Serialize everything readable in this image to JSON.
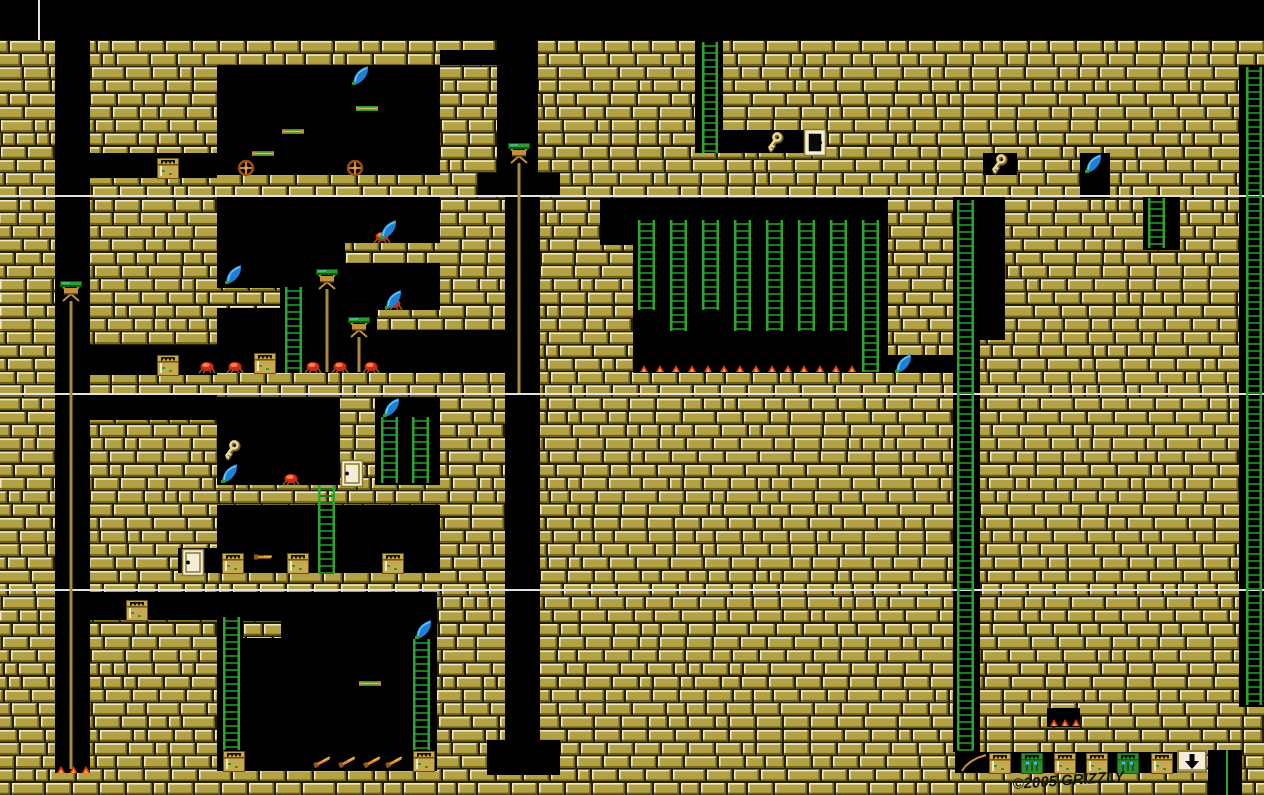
{
  "meta": {
    "width": 1264,
    "height": 795,
    "signature_text": "©2005 GRIZZLY"
  },
  "palette": {
    "black": "#000000",
    "brick_face": "#b3a245",
    "brick_light": "#efe8c6",
    "brick_dark": "#6e6010",
    "mortar": "#251f02",
    "white_line": "#e2e2e2",
    "ladder_rail": "#2fa32f",
    "ladder_rung": "#1e7a1e",
    "lamp_green": "#2f9a2f",
    "lamp_green_dark": "#0f5c0f",
    "wood": "#c09040",
    "pole": "#a98a30",
    "blade": "#1f7fd6",
    "blade_hi": "#67c9ee",
    "blade_hilt": "#2f9a2f",
    "key": "#e8d8a0",
    "key_dark": "#7a6a20",
    "chest": "#c9a94f",
    "chest_dark": "#6a5210",
    "chest_teeth": "#141008",
    "zombie": "#2e8b2e",
    "zombie_dark": "#175c17",
    "zombie_eye": "#3fc8e8",
    "crab": "#cc2a14",
    "crab_hi": "#ff7a50",
    "crab_leg": "#8a5a20",
    "flame": "#e03c10",
    "flame_hi": "#ff9838",
    "dagger": "#e08828",
    "sign_bg": "#f4eed6",
    "sign_border": "#8a7830",
    "ink": "#141414"
  },
  "map": {
    "brick_area": [
      0,
      40,
      1264,
      755
    ],
    "brick_seed": 7,
    "black_regions": [
      [
        0,
        0,
        1264,
        40
      ],
      [
        55,
        40,
        35,
        733
      ],
      [
        90,
        153,
        127,
        25
      ],
      [
        90,
        345,
        127,
        30
      ],
      [
        90,
        395,
        127,
        25
      ],
      [
        90,
        592,
        347,
        28
      ],
      [
        217,
        65,
        223,
        110
      ],
      [
        440,
        50,
        60,
        15
      ],
      [
        217,
        196,
        223,
        177
      ],
      [
        440,
        330,
        65,
        43
      ],
      [
        497,
        40,
        41,
        133
      ],
      [
        478,
        173,
        82,
        23
      ],
      [
        505,
        196,
        35,
        544
      ],
      [
        487,
        740,
        73,
        35
      ],
      [
        600,
        198,
        33,
        47
      ],
      [
        633,
        198,
        255,
        175
      ],
      [
        888,
        355,
        65,
        18
      ],
      [
        953,
        196,
        27,
        556
      ],
      [
        980,
        196,
        25,
        144
      ],
      [
        983,
        153,
        34,
        22
      ],
      [
        1080,
        153,
        30,
        45
      ],
      [
        1143,
        196,
        37,
        54
      ],
      [
        695,
        40,
        28,
        90
      ],
      [
        695,
        130,
        110,
        23
      ],
      [
        1239,
        65,
        25,
        642
      ],
      [
        217,
        397,
        123,
        88
      ],
      [
        375,
        397,
        65,
        88
      ],
      [
        217,
        505,
        223,
        68
      ],
      [
        178,
        548,
        39,
        25
      ],
      [
        217,
        620,
        220,
        151
      ],
      [
        1047,
        708,
        33,
        19
      ],
      [
        955,
        752,
        252,
        21
      ],
      [
        1208,
        750,
        34,
        45
      ]
    ],
    "brick_patches": [
      [
        217,
        288,
        63,
        20
      ],
      [
        345,
        243,
        95,
        20
      ],
      [
        377,
        310,
        63,
        20
      ],
      [
        118,
        620,
        99,
        20
      ],
      [
        243,
        621,
        38,
        17
      ]
    ],
    "white_lines_y": [
      195,
      393,
      589
    ],
    "white_vline": {
      "x": 38,
      "y1": 0,
      "y2": 40
    },
    "ladders": [
      [
        702,
        42,
        16,
        111
      ],
      [
        638,
        220,
        17,
        90
      ],
      [
        670,
        220,
        17,
        111
      ],
      [
        702,
        220,
        17,
        90
      ],
      [
        734,
        220,
        17,
        111
      ],
      [
        766,
        220,
        17,
        111
      ],
      [
        798,
        220,
        17,
        111
      ],
      [
        830,
        220,
        17,
        111
      ],
      [
        862,
        220,
        17,
        152
      ],
      [
        957,
        200,
        17,
        550
      ],
      [
        1148,
        198,
        17,
        50
      ],
      [
        1246,
        67,
        16,
        638
      ],
      [
        285,
        287,
        17,
        86
      ],
      [
        381,
        417,
        17,
        66
      ],
      [
        412,
        417,
        17,
        66
      ],
      [
        318,
        485,
        17,
        88
      ],
      [
        223,
        617,
        17,
        133
      ],
      [
        413,
        639,
        17,
        111
      ]
    ],
    "lamps": [
      {
        "x": 71,
        "y": 281,
        "pole_to": 769
      },
      {
        "x": 519,
        "y": 143,
        "pole_to": 393
      },
      {
        "x": 327,
        "y": 269,
        "pole_to": 372
      },
      {
        "x": 359,
        "y": 317,
        "pole_to": 372
      }
    ],
    "scimitars": [
      [
        352,
        66
      ],
      [
        225,
        265
      ],
      [
        380,
        220
      ],
      [
        385,
        290
      ],
      [
        895,
        354
      ],
      [
        221,
        464
      ],
      [
        383,
        398
      ],
      [
        415,
        620
      ],
      [
        1085,
        154
      ]
    ],
    "keys": [
      [
        766,
        133
      ],
      [
        990,
        155
      ],
      [
        223,
        441
      ]
    ],
    "doors": [
      {
        "x": 806,
        "y": 131,
        "dark": true,
        "keyhole": "right"
      },
      {
        "x": 343,
        "y": 462,
        "dark": false,
        "keyhole": "left"
      },
      {
        "x": 184,
        "y": 551,
        "dark": false,
        "keyhole": "left"
      }
    ],
    "chests": [
      [
        158,
        159
      ],
      [
        158,
        356
      ],
      [
        255,
        354
      ],
      [
        223,
        554
      ],
      [
        288,
        554
      ],
      [
        383,
        554
      ],
      [
        127,
        601
      ],
      [
        224,
        752
      ],
      [
        414,
        752
      ],
      [
        990,
        754
      ],
      [
        1055,
        754
      ],
      [
        1087,
        754
      ],
      [
        1152,
        754
      ]
    ],
    "zombies": [
      [
        1022,
        754
      ],
      [
        1118,
        754
      ]
    ],
    "crabs": [
      [
        200,
        362
      ],
      [
        228,
        362
      ],
      [
        306,
        362
      ],
      [
        333,
        362
      ],
      [
        364,
        362
      ],
      [
        375,
        232
      ],
      [
        387,
        299
      ],
      [
        284,
        474
      ]
    ],
    "staffs": [
      [
        356,
        106
      ],
      [
        282,
        129
      ],
      [
        252,
        151
      ],
      [
        359,
        681
      ]
    ],
    "wheels": [
      [
        246,
        168
      ],
      [
        355,
        168
      ]
    ],
    "daggers": [
      {
        "x": 256,
        "y": 557,
        "angle": 0
      },
      {
        "x": 316,
        "y": 765,
        "angle": -28
      },
      {
        "x": 341,
        "y": 765,
        "angle": -28
      },
      {
        "x": 366,
        "y": 765,
        "angle": -28
      },
      {
        "x": 388,
        "y": 765,
        "angle": -28
      }
    ],
    "flame_rows": [
      {
        "x1": 640,
        "x2": 848,
        "y": 365,
        "count": 14
      },
      {
        "x1": 57,
        "x2": 82,
        "y": 766,
        "count": 3
      },
      {
        "x1": 1050,
        "x2": 1072,
        "y": 719,
        "count": 3
      }
    ],
    "rope": {
      "x1": 962,
      "y1": 771,
      "cx": 968,
      "cy": 760,
      "x2": 986,
      "y2": 755
    },
    "pit_pole": {
      "x": 1226,
      "y1": 750,
      "y2": 795
    },
    "arrow_sign": {
      "x": 1177,
      "y": 750,
      "w": 30,
      "h": 23
    },
    "signature": {
      "x": 1013,
      "y": 789,
      "angle": -4
    }
  }
}
